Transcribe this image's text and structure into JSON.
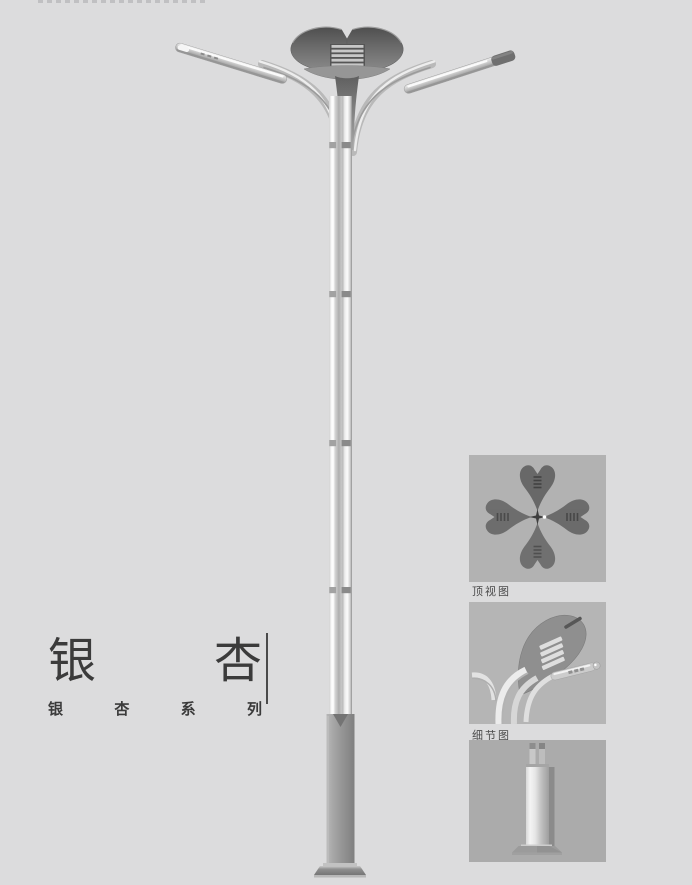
{
  "page": {
    "background_color": "#dcdcdd",
    "kind": "product-catalog-page"
  },
  "product": {
    "name": "银杏",
    "name_chars": [
      "银",
      "杏"
    ],
    "series": "银杏系列",
    "series_chars": [
      "银",
      "杏",
      "系",
      "列"
    ]
  },
  "insets": [
    {
      "label": "顶视图"
    },
    {
      "label": "细节图"
    },
    {
      "label": ""
    }
  ],
  "illustration": {
    "subject": "double-arm ginkgo-leaf street lamp, full elevation view",
    "colors": {
      "background": "#dcdcdd",
      "panel_gray": "#b2b2b2",
      "pole_silver": "#d6d6d6",
      "head_dark_gray": "#6a6a6a",
      "base_gray": "#949494",
      "text_dark": "#3b3b3b"
    }
  }
}
